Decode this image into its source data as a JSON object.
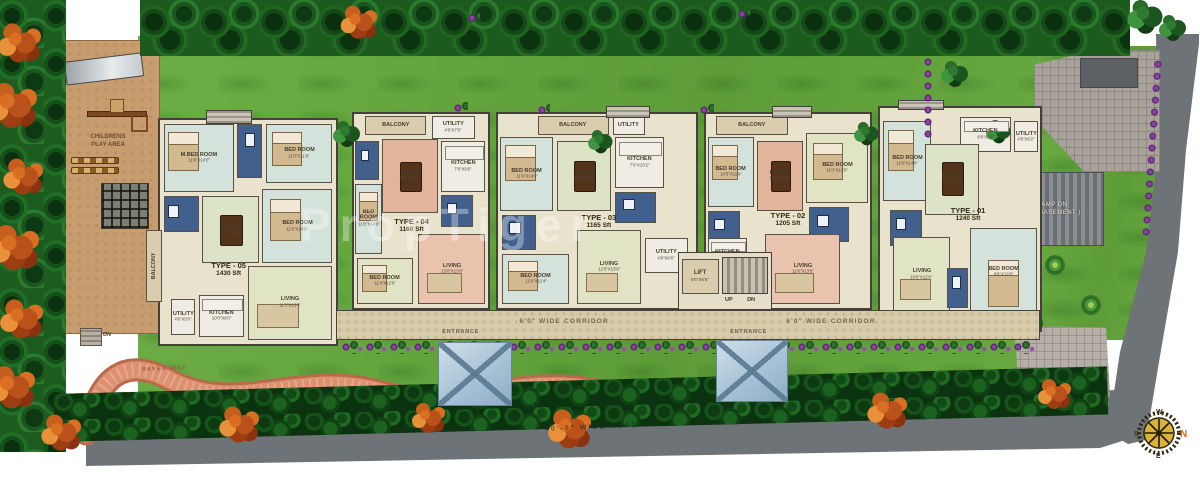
{
  "site": {
    "watermark": "PropTiger",
    "road_label": "40'-0\" WIDE ROAD",
    "paved_way_label": "PAVED WAY",
    "corridor_label": "6'0\" WIDE CORRIDOR",
    "entrance_label": "ENTRANCE",
    "steps_dn_label": "DN",
    "play_area": {
      "line1": "CHILDRENS",
      "line2": "PLAY AREA"
    },
    "ramp": {
      "line1": "RAMP DN",
      "line2": "( TO BASEMENT )"
    },
    "core": {
      "lift": "LIFT",
      "lift_dims": "6'6\"X6'6\"",
      "up": "UP",
      "dn": "DN"
    },
    "compass": {
      "n": "N",
      "e": "E",
      "s": "S",
      "w": "W"
    },
    "palette": {
      "grass": "#67a93f",
      "road": "#6d7377",
      "toilet_blue": "#41608e",
      "dining_pink": "#e2b49c",
      "corridor_tan": "#d7caa9",
      "play_tan": "#c79d6f",
      "compass_north": "#e0641e"
    }
  },
  "units": [
    {
      "type": "TYPE - 05",
      "area": "1430 Sft",
      "rooms": {
        "mbed": {
          "label": "M.BED ROOM",
          "dims": "11'6\"X14'0\""
        },
        "bed1": {
          "label": "BED ROOM",
          "dims": "11'0\"X11'6\""
        },
        "bed2": {
          "label": "BED ROOM",
          "dims": "11'6\"X14'0\""
        },
        "dining": {
          "label": "DINING",
          "dims": "10'6\"X11'6\""
        },
        "balcony": {
          "label": "BALCONY",
          "dims": "4'6\"X14'6\""
        },
        "utility": {
          "label": "UTILITY",
          "dims": "4'6\"X5'0\""
        },
        "kitchen": {
          "label": "KITCHEN",
          "dims": "10'0\"X8'0\""
        },
        "living": {
          "label": "LIVING",
          "dims": "11'3\"X13'6\""
        }
      }
    },
    {
      "type": "TYPE - 04",
      "area": "1160 Sft",
      "rooms": {
        "balcony": {
          "label": "BALCONY",
          "dims": "10'6\"X4'6\""
        },
        "utility": {
          "label": "UTILITY",
          "dims": "4'6\"X7'6\""
        },
        "bed1": {
          "label": "BED ROOM",
          "dims": "11'0\"X14'6\""
        },
        "kitchen": {
          "label": "KITCHEN",
          "dims": "7'6\"X9'6\""
        },
        "dining": {
          "label": "DINING",
          "dims": "10'0\"X11'6\""
        },
        "bed2": {
          "label": "BED ROOM",
          "dims": "11'4\"X12'6\""
        },
        "living": {
          "label": "LIVING",
          "dims": "10'0\"X13'6\""
        }
      }
    },
    {
      "type": "TYPE - 03",
      "area": "1165 Sft",
      "rooms": {
        "balcony": {
          "label": "BALCONY",
          "dims": "10'6\"X4'6\""
        },
        "utility": {
          "label": "UTILITY",
          "dims": "4'6\"X4'6\""
        },
        "bed1": {
          "label": "BED ROOM",
          "dims": "11'6\"X14'6\""
        },
        "kitchen": {
          "label": "KITCHEN",
          "dims": "7'0\"X10'2\""
        },
        "dining": {
          "label": "DINING",
          "dims": "10'0\"X11'4\""
        },
        "bed2": {
          "label": "BED ROOM",
          "dims": "12'0\"X11'4\""
        },
        "living": {
          "label": "LIVING",
          "dims": "12'0\"X13'6\""
        },
        "utility2": {
          "label": "UTILITY",
          "dims": "4'6\"X6'6\""
        }
      }
    },
    {
      "type": "TYPE - 02",
      "area": "1205 Sft",
      "rooms": {
        "balcony": {
          "label": "BALCONY",
          "dims": "10'2\"X4'6\""
        },
        "bed1": {
          "label": "BED ROOM",
          "dims": "10'6\"X11'6\""
        },
        "bed2": {
          "label": "BED ROOM",
          "dims": "11'0\"X12'6\""
        },
        "dining": {
          "label": "DINING",
          "dims": "10'2\"X11'6\""
        },
        "kitchen": {
          "label": "KITCHEN",
          "dims": "7'0\"X9'6\""
        },
        "living": {
          "label": "LIVING",
          "dims": "11'6\"X13'6\""
        }
      }
    },
    {
      "type": "TYPE - 01",
      "area": "1240 Sft",
      "rooms": {
        "bed1": {
          "label": "BED ROOM",
          "dims": "11'6\"X14'6\""
        },
        "kitchen": {
          "label": "KITCHEN",
          "dims": "8'0\"X9'6\""
        },
        "utility": {
          "label": "UTILITY",
          "dims": "4'6\"X6'2\""
        },
        "dining": {
          "label": "DINING",
          "dims": "11'0\"X12'6\""
        },
        "living": {
          "label": "LIVING",
          "dims": "10'6\"X12'6\""
        },
        "bed2": {
          "label": "BED ROOM",
          "dims": "9'6\"X12'6\""
        }
      }
    }
  ]
}
